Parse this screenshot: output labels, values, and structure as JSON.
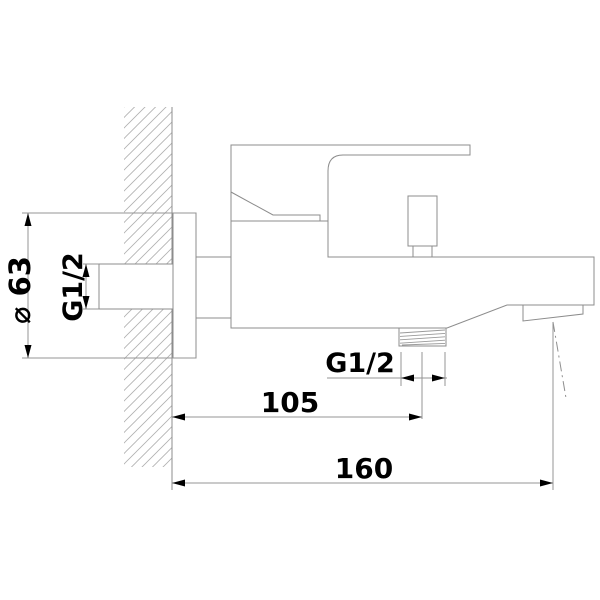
{
  "drawing": {
    "title": "Bath mixer tap installation drawing - side view",
    "background_color": "#ffffff",
    "line_color": "#8c8c8c",
    "hatch_color": "#b0b0b0",
    "text_color": "#000000",
    "labels": {
      "flange_diameter": "⌀ 63",
      "inlet_thread": "G1/2",
      "outlet_thread": "G1/2",
      "wall_to_outlet_center": "105",
      "wall_to_spout_center": "160"
    }
  }
}
